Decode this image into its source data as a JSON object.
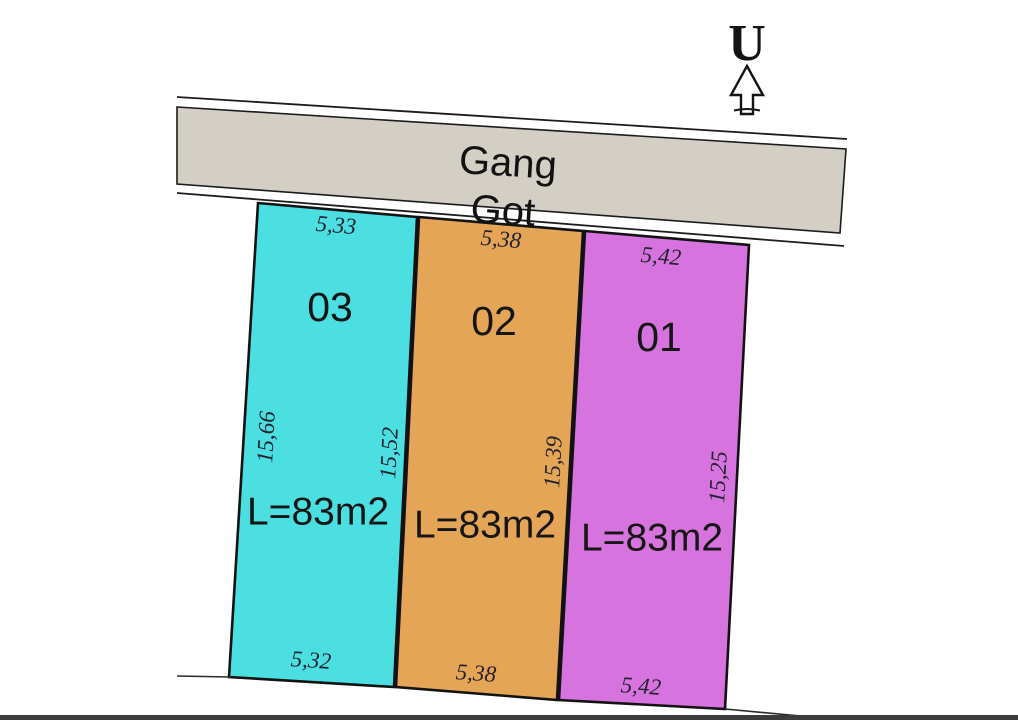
{
  "north_arrow": {
    "label": "U"
  },
  "road": {
    "label_line1": "Gang",
    "label_line2": "Got",
    "fill": "#D3CFC5"
  },
  "plots": [
    {
      "id": "03",
      "area_label": "L=83m2",
      "width_top": "5,33",
      "width_bottom": "5,32",
      "length_left": "15,66",
      "length_right": "15,52",
      "fill": "#4BDFE2"
    },
    {
      "id": "02",
      "area_label": "L=83m2",
      "width_top": "5,38",
      "width_bottom": "5,38",
      "length_right": "15,39",
      "fill": "#E5A556"
    },
    {
      "id": "01",
      "area_label": "L=83m2",
      "width_top": "5,42",
      "width_bottom": "5,42",
      "length_right": "15,25",
      "fill": "#D773DF"
    }
  ],
  "footer_bar_color": "#3C3C3C"
}
